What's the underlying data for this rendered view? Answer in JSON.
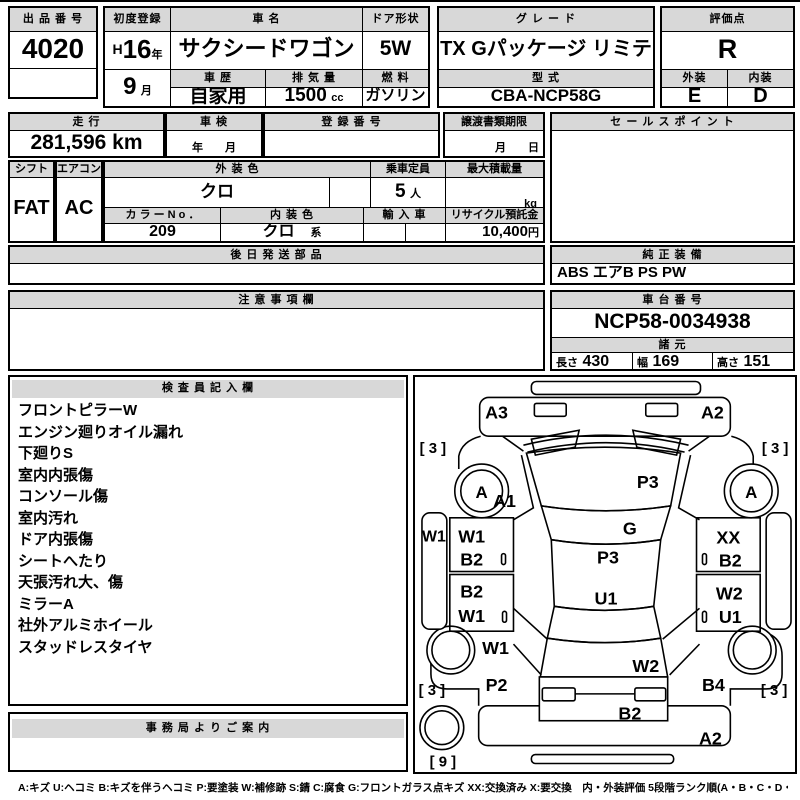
{
  "colors": {
    "header_bg": "#d8d8d8",
    "border": "#000000"
  },
  "top": {
    "lot": {
      "label": "出 品 番 号",
      "value": "4020"
    },
    "first_reg": {
      "label": "初度登録",
      "era": "H",
      "year": "16",
      "year_unit": "年",
      "month": "9",
      "month_unit": "月"
    },
    "car_name": {
      "label": "車 名",
      "value": "サクシードワゴン"
    },
    "history": {
      "label": "車 歴",
      "value": "自家用"
    },
    "displacement": {
      "label": "排 気 量",
      "value": "1500",
      "unit": "cc"
    },
    "door": {
      "label": "ドア形状",
      "value": "5W"
    },
    "fuel": {
      "label": "燃 料",
      "value": "ガソリン"
    },
    "grade": {
      "label": "グ レ ー ド",
      "value": "TX Gパッケージ リミテッド"
    },
    "model": {
      "label": "型 式",
      "value": "CBA-NCP58G"
    },
    "score": {
      "label": "評価点",
      "value": "R"
    },
    "exterior": {
      "label": "外装",
      "value": "E"
    },
    "interior": {
      "label": "内装",
      "value": "D"
    }
  },
  "row2": {
    "mileage": {
      "label": "走 行",
      "value": "281,596 km"
    },
    "inspection": {
      "label": "車 検",
      "placeholder": "年　　月"
    },
    "reg_no": {
      "label": "登 録 番 号",
      "value": ""
    },
    "transfer_deadline": {
      "label": "譲渡書類期限",
      "placeholder": "月　　日"
    },
    "sales_point": {
      "label": "セ ー ル ス ポ イ ン ト",
      "value": ""
    }
  },
  "row3": {
    "shift": {
      "label": "シフト",
      "value": "FAT"
    },
    "aircon": {
      "label": "エアコン",
      "value": "AC"
    },
    "ext_color": {
      "label": "外 装 色",
      "value": "クロ"
    },
    "capacity": {
      "label": "乗車定員",
      "value": "5",
      "unit": "人"
    },
    "max_load": {
      "label": "最大積載量",
      "value": "",
      "unit": "kg"
    },
    "color_no": {
      "label": "カ ラ ー N o ．",
      "value": "209"
    },
    "int_color": {
      "label": "内 装 色",
      "value": "クロ",
      "suffix": "系"
    },
    "imported": {
      "label": "輸 入 車",
      "value": ""
    },
    "recycle_deposit": {
      "label": "リサイクル預託金",
      "value": "10,400",
      "unit": "円"
    }
  },
  "row4": {
    "later_parts": {
      "label": "後 日 発 送 部 品",
      "value": ""
    },
    "genuine_equipment": {
      "label": "純 正 装 備",
      "value": "ABS エアB PS PW"
    }
  },
  "row5": {
    "notes": {
      "label": "注 意 事 項 欄",
      "value": ""
    },
    "chassis_no": {
      "label": "車 台 番 号",
      "value": "NCP58-0034938"
    },
    "specs": {
      "label": "諸 元",
      "length_label": "長さ",
      "length": "430",
      "width_label": "幅",
      "width": "169",
      "height_label": "高さ",
      "height": "151"
    }
  },
  "inspector": {
    "label": "検 査 員 記 入 欄",
    "items": [
      "フロントピラーW",
      "エンジン廻りオイル漏れ",
      "下廻りS",
      "室内内張傷",
      "コンソール傷",
      "室内汚れ",
      "ドア内張傷",
      "シートへたり",
      "天張汚れ大、傷",
      "ミラーA",
      "社外アルミホイール",
      "スタッドレスタイヤ"
    ]
  },
  "office": {
    "label": "事 務 局 よ り ご 案 内",
    "value": ""
  },
  "diagram": {
    "front_bumper_left": "A3",
    "front_bumper_right": "A2",
    "windshield": "P3",
    "front_glass": "G",
    "roof_front": "P3",
    "roof_center": "U1",
    "front_left_tire": "[ 3 ]",
    "front_right_tire": "[ 3 ]",
    "rear_left_tire": "[ 3 ]",
    "rear_right_tire": "[ 3 ]",
    "spare_tire": "[ 9 ]",
    "front_left_wheel": "A",
    "front_right_wheel": "A",
    "left_fender": "A1",
    "left_sill": "W1",
    "left_front_door_1": "W1",
    "left_front_door_2": "B2",
    "left_rear_door_1": "B2",
    "left_rear_door_2": "W1",
    "left_quarter_1": "W1",
    "left_quarter_2": "P2",
    "right_front_door_1": "XX",
    "right_front_door_2": "B2",
    "right_rear_door_1": "W2",
    "right_rear_door_2": "U1",
    "right_quarter": "B4",
    "tailgate": "W2",
    "rear_panel": "B2",
    "rear_bumper": "A2"
  },
  "legend": "A:キズ U:ヘコミ B:キズを伴うヘコミ P:要塗装 W:補修跡 S:錆 C:腐食 G:フロントガラス点キズ XX:交換済み X:要交換　内・外装評価 5段階ランク順(A・B・C・D・E) 1"
}
